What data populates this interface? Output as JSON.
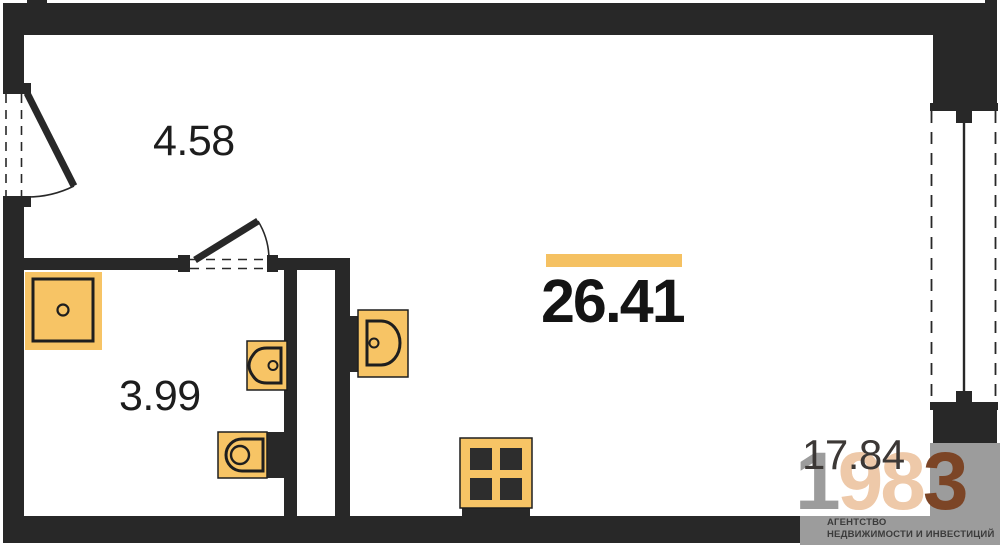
{
  "plan": {
    "total_area": "26.41",
    "rooms": [
      {
        "name": "hallway",
        "area": "4.58"
      },
      {
        "name": "bathroom",
        "area": "3.99"
      },
      {
        "name": "living-room",
        "area": "17.84"
      }
    ],
    "fixtures": [
      "shower-tray",
      "bathroom-sink",
      "toilet",
      "kitchen-sink",
      "stove"
    ],
    "colors": {
      "wall": "#282828",
      "fixture_fill": "#F7C465",
      "accent_bar": "#F5C162",
      "label_text": "#1D1D1D"
    }
  },
  "logo": {
    "digits": [
      {
        "char": "1",
        "color": "#9C9C9C"
      },
      {
        "char": "9",
        "color": "#EEC9A9"
      },
      {
        "char": "8",
        "color": "#EEC9A9"
      },
      {
        "char": "3",
        "color": "#7C4526"
      }
    ],
    "tagline": [
      "АГЕНТСТВО",
      "НЕДВИЖИМОСТИ И ИНВЕСТИЦИЙ"
    ],
    "background": "#9C9C9C"
  }
}
